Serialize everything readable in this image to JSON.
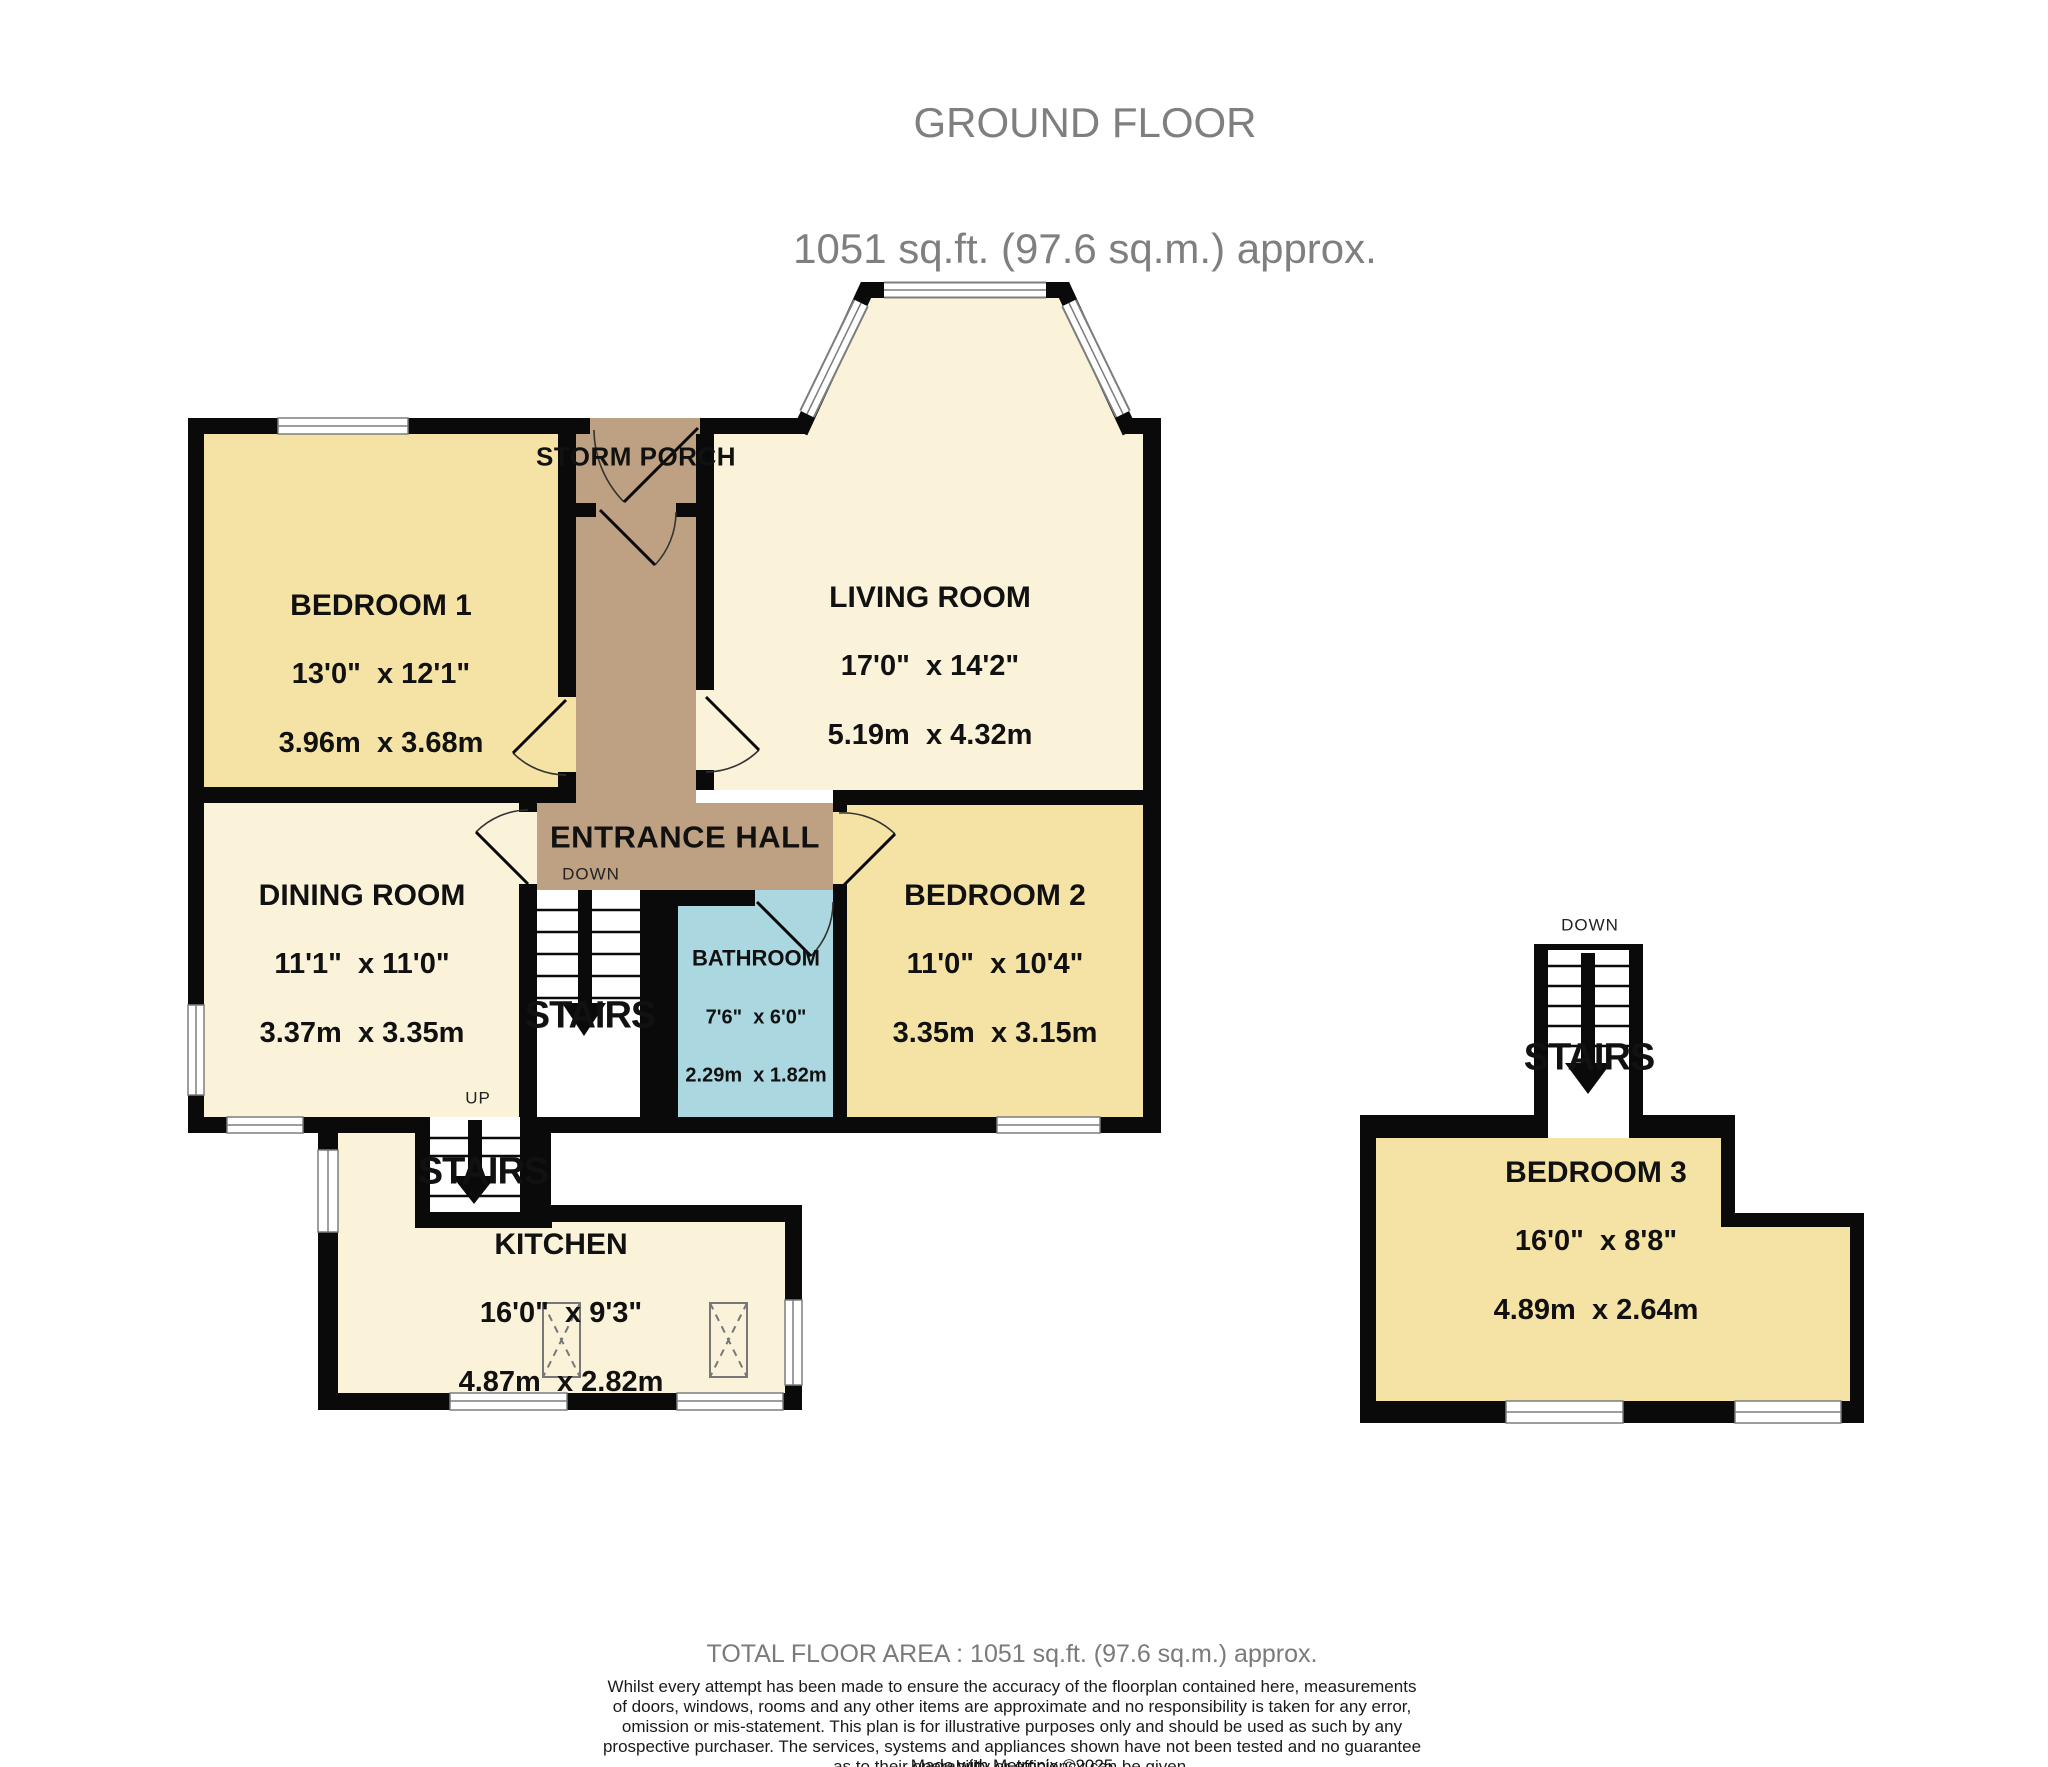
{
  "header": {
    "line1": "GROUND FLOOR",
    "line2": "1051 sq.ft. (97.6 sq.m.) approx."
  },
  "rooms": {
    "bedroom1": {
      "name": "BEDROOM 1",
      "imperial": "13'0\"  x 12'1\"",
      "metric": "3.96m  x 3.68m"
    },
    "storm_porch": {
      "name": "STORM PORCH"
    },
    "living_room": {
      "name": "LIVING ROOM",
      "imperial": "17'0\"  x 14'2\"",
      "metric": "5.19m  x 4.32m"
    },
    "entrance_hall": {
      "name": "ENTRANCE HALL",
      "down_label": "DOWN"
    },
    "dining_room": {
      "name": "DINING ROOM",
      "imperial": "11'1\"  x 11'0\"",
      "metric": "3.37m  x 3.35m"
    },
    "bedroom2": {
      "name": "BEDROOM 2",
      "imperial": "11'0\"  x 10'4\"",
      "metric": "3.35m  x 3.15m"
    },
    "bathroom": {
      "name": "BATHROOM",
      "imperial": "7'6\"  x 6'0\"",
      "metric": "2.29m  x 1.82m"
    },
    "kitchen": {
      "name": "KITCHEN",
      "imperial": "16'0\"  x 9'3\"",
      "metric": "4.87m  x 2.82m"
    },
    "bedroom3": {
      "name": "BEDROOM 3",
      "imperial": "16'0\"  x 8'8\"",
      "metric": "4.89m  x 2.64m"
    },
    "stairs_main": {
      "name": "STAIRS"
    },
    "stairs_kitchen": {
      "name": "STAIRS",
      "up_label": "UP"
    },
    "stairs_bedroom3": {
      "name": "STAIRS",
      "down_label": "DOWN"
    }
  },
  "footer": {
    "total": "TOTAL FLOOR AREA : 1051 sq.ft. (97.6 sq.m.) approx.",
    "disclaimer_lines": [
      "Whilst every attempt has been made to ensure the accuracy of the floorplan contained here, measurements",
      "of doors, windows, rooms and any other items are approximate and no responsibility is taken for any error,",
      "omission or mis-statement. This plan is for illustrative purposes only and should be used as such by any",
      "prospective purchaser. The services, systems and appliances shown have not been tested and no guarantee",
      "as to their operability or efficiency can be given."
    ],
    "credit": "Made with Metropix ©2025"
  },
  "colors": {
    "bedroom_fill": "#f5e3a6",
    "reception_fill": "#faf3da",
    "hall_fill": "#bea182",
    "bathroom_fill": "#abd7e0",
    "wall": "#0a0a0a",
    "window_line": "#7d7d7d",
    "header_text": "#7f7f7f"
  }
}
